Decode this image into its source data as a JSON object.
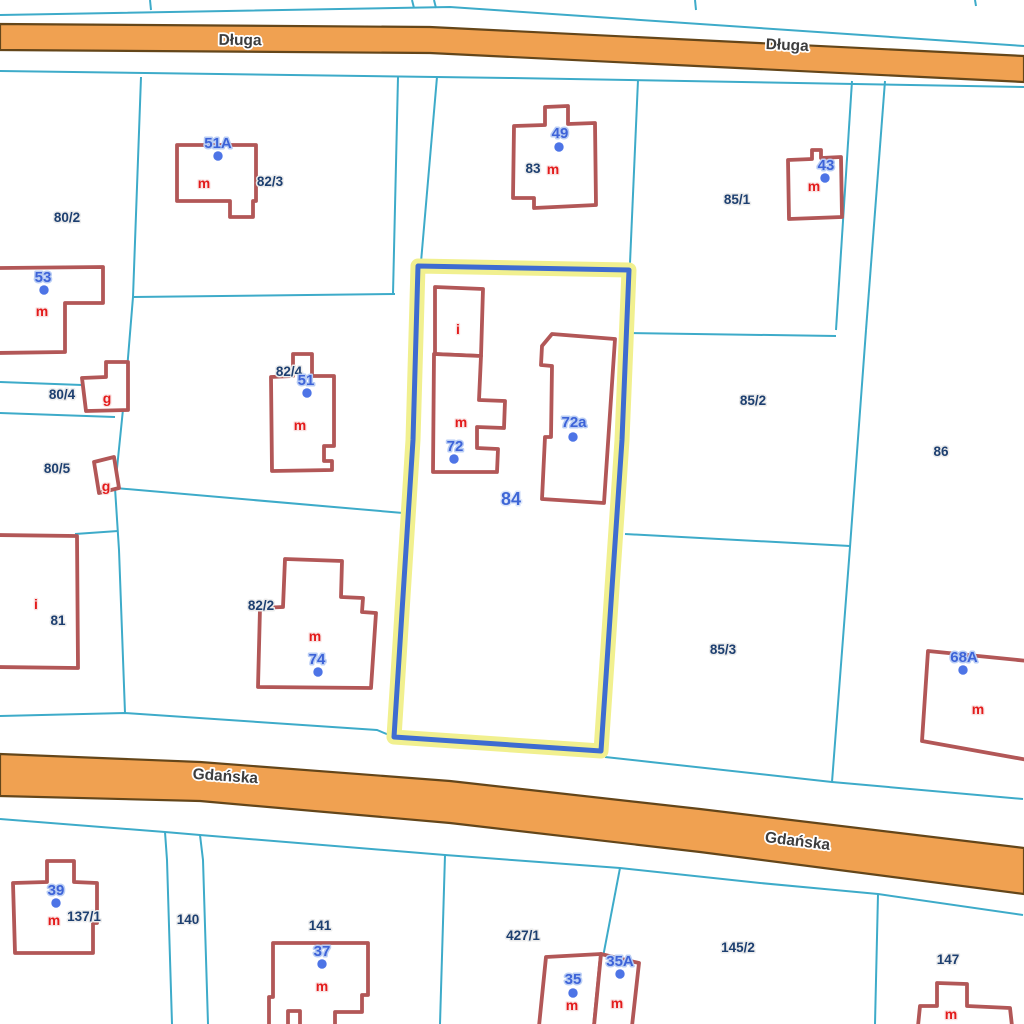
{
  "map": {
    "title": "Cadastral map with highlighted parcel 84 between Długa and Gdańska streets",
    "colors": {
      "background": "#ffffff",
      "boundary_line": "#3dabc9",
      "building_stroke": "#b25757",
      "building_fill": "#ffffff",
      "road_fill": "#f0a151",
      "road_edge": "#64461a",
      "road_text": "#3d3d3d",
      "road_text_halo": "#ffffff",
      "selected_stroke": "#3e6cd1",
      "selected_halo": "#f1f08f",
      "parcel_label": "#1d3f70",
      "parcel_label_halo": "#ececec",
      "selected_parcel_label": "#3e66d6",
      "selected_parcel_label_halo": "#dce6fa",
      "address_text": "#3d63d8",
      "address_halo": "#b9cdf4",
      "address_dot": "#4d74e6",
      "letter_text": "#e31b1b",
      "letter_halo": "#f9e3e3"
    },
    "roads": [
      {
        "name": "road-dluga",
        "path": "M0,24 L430,27 L1024,56 L1024,82 L430,53 L0,50 Z",
        "labels": [
          {
            "text": "Długa",
            "x": 240,
            "y": 45,
            "rotate": 0.8
          },
          {
            "text": "Długa",
            "x": 787,
            "y": 50,
            "rotate": 2.8
          }
        ]
      },
      {
        "name": "road-gdanska",
        "path": "M0,754 L200,762 L450,781 L700,809 L1024,848 L1024,894 L700,852 L450,823 L200,801 L0,796 Z",
        "labels": [
          {
            "text": "Gdańska",
            "x": 225,
            "y": 781,
            "rotate": 4
          },
          {
            "text": "Gdańska",
            "x": 797,
            "y": 846,
            "rotate": 7
          }
        ]
      }
    ],
    "boundaries": [
      {
        "points": "0,15 450,7 1024,46"
      },
      {
        "points": "150,0 151,10"
      },
      {
        "points": "412,0 414,8"
      },
      {
        "points": "434,0 436,8"
      },
      {
        "points": "695,0 696,10"
      },
      {
        "points": "975,0 976,6"
      },
      {
        "points": "0,71 512,78 1024,87"
      },
      {
        "points": "141,77 133,297 127,370 115,488 119,550 125,713"
      },
      {
        "points": "133,297 395,294"
      },
      {
        "points": "398,77 393,294"
      },
      {
        "points": "437,77 421,262"
      },
      {
        "points": "638,80 630,263"
      },
      {
        "points": "852,81 836,330"
      },
      {
        "points": "885,81 866,330"
      },
      {
        "points": "628,333 836,336"
      },
      {
        "points": "866,330 850,547 832,782"
      },
      {
        "points": "625,534 850,546"
      },
      {
        "points": "115,488 403,513"
      },
      {
        "points": "0,382 82,385"
      },
      {
        "points": "0,413 115,417"
      },
      {
        "points": "75,534 118,531"
      },
      {
        "points": "0,716 125,713 377,730 394,737"
      },
      {
        "points": "605,757 832,782 1023,799"
      },
      {
        "points": "0,819 165,832 200,835 445,855 512,860 620,868 760,883 878,894 1023,915"
      },
      {
        "points": "165,832 167,860 172,1024"
      },
      {
        "points": "200,835 203,860 208,1024"
      },
      {
        "points": "445,855 440,1024"
      },
      {
        "points": "620,868 603,957"
      },
      {
        "points": "878,894 875,1024"
      }
    ],
    "selected_parcel": {
      "path": "M418,266 L629,270 L622,440 L601,751 L394,737 L413,440 Z",
      "label": {
        "text": "84",
        "x": 511,
        "y": 505
      }
    },
    "parcel_labels": [
      {
        "text": "80/2",
        "x": 67,
        "y": 222
      },
      {
        "text": "82/3",
        "x": 270,
        "y": 186
      },
      {
        "text": "83",
        "x": 533,
        "y": 173
      },
      {
        "text": "85/1",
        "x": 737,
        "y": 204
      },
      {
        "text": "80/4",
        "x": 62,
        "y": 399
      },
      {
        "text": "82/4",
        "x": 289,
        "y": 376
      },
      {
        "text": "85/2",
        "x": 753,
        "y": 405
      },
      {
        "text": "86",
        "x": 941,
        "y": 456
      },
      {
        "text": "80/5",
        "x": 57,
        "y": 473
      },
      {
        "text": "81",
        "x": 58,
        "y": 625
      },
      {
        "text": "82/2",
        "x": 261,
        "y": 610
      },
      {
        "text": "85/3",
        "x": 723,
        "y": 654
      },
      {
        "text": "137/1",
        "x": 84,
        "y": 921
      },
      {
        "text": "140",
        "x": 188,
        "y": 924
      },
      {
        "text": "141",
        "x": 320,
        "y": 930
      },
      {
        "text": "427/1",
        "x": 523,
        "y": 940
      },
      {
        "text": "145/2",
        "x": 738,
        "y": 952
      },
      {
        "text": "147",
        "x": 948,
        "y": 964
      }
    ],
    "buildings": [
      {
        "name": "building-51a",
        "path": "M177,145 L256,145 L256,201 L253,201 L253,217 L230,217 L230,201 L177,201 Z",
        "letter": {
          "text": "m",
          "x": 204,
          "y": 188
        }
      },
      {
        "name": "building-49",
        "path": "M514,126 L545,125 L545,107 L568,106 L568,124 L595,123 L596,205 L534,208 L534,198 L513,198 Z",
        "letter": {
          "text": "m",
          "x": 553,
          "y": 174
        }
      },
      {
        "name": "building-43",
        "path": "M788,160 L812,159 L812,150 L821,150 L821,158 L841,157 L842,217 L789,219 Z",
        "letter": {
          "text": "m",
          "x": 814,
          "y": 191
        }
      },
      {
        "name": "building-53",
        "path": "M-4,268 L103,267 L103,303 L65,303 L65,352 L-4,353 Z",
        "letter": {
          "text": "m",
          "x": 42,
          "y": 316
        }
      },
      {
        "name": "building-garage-80-4",
        "path": "M82,378 L106,377 L106,362 L128,362 L128,410 L86,411 Z",
        "letter": {
          "text": "g",
          "x": 107,
          "y": 403
        }
      },
      {
        "name": "building-garage-80-5",
        "path": "M94,462 L114,457 L119,488 L99,493 Z",
        "letter": {
          "text": "g",
          "x": 106,
          "y": 491
        }
      },
      {
        "name": "building-51",
        "path": "M271,377 L293,376 L293,354 L312,354 L312,376 L334,376 L334,446 L324,446 L324,461 L332,461 L332,470 L272,471 Z",
        "letter": {
          "text": "m",
          "x": 300,
          "y": 430
        }
      },
      {
        "name": "building-84-i",
        "path": "M435,287 L483,289 L481,356 L435,354 Z",
        "letter": {
          "text": "i",
          "x": 458,
          "y": 334
        }
      },
      {
        "name": "building-84-m",
        "path": "M434,354 L481,356 L479,400 L505,401 L504,428 L477,427 L477,448 L498,449 L497,472 L433,472 Z",
        "letter": {
          "text": "m",
          "x": 461,
          "y": 427
        }
      },
      {
        "name": "building-72a",
        "path": "M552,334 L615,339 L604,503 L542,499 L545,437 L551,437 L552,366 L541,365 L542,346 Z"
      },
      {
        "name": "building-74",
        "path": "M285,559 L342,561 L341,597 L363,598 L362,612 L376,613 L371,688 L258,687 L260,608 L283,607 Z",
        "letter": {
          "text": "m",
          "x": 315,
          "y": 641
        }
      },
      {
        "name": "building-81",
        "path": "M-4,535 L77,536 L78,668 L-4,667 Z",
        "letter": {
          "text": "i",
          "x": 36,
          "y": 609
        }
      },
      {
        "name": "building-68a",
        "path": "M928,651 L1028,661 L1028,760 L922,741 Z",
        "letter": {
          "text": "m",
          "x": 978,
          "y": 714
        }
      },
      {
        "name": "building-39",
        "path": "M13,883 L47,882 L47,861 L74,861 L74,882 L97,883 L97,923 L93,923 L93,953 L15,953 Z",
        "letter": {
          "text": "m",
          "x": 54,
          "y": 925
        }
      },
      {
        "name": "building-37",
        "path": "M273,943 L368,943 L368,995 L362,995 L362,1012 L335,1012 L335,1026 L300,1026 L300,1011 L288,1011 L288,1026 L269,1026 L269,997 L273,997 Z",
        "letter": {
          "text": "m",
          "x": 322,
          "y": 991
        }
      },
      {
        "name": "building-35",
        "path": "M546,957 L601,954 L594,1026 L539,1026 Z",
        "letter": {
          "text": "m",
          "x": 572,
          "y": 1010
        }
      },
      {
        "name": "building-35a",
        "path": "M601,954 L639,963 L632,1026 L594,1026 Z",
        "letter": {
          "text": "m",
          "x": 617,
          "y": 1008
        }
      },
      {
        "name": "building-147",
        "path": "M937,983 L967,984 L967,1006 L1010,1008 L1012,1026 L918,1026 L920,1006 L937,1006 Z",
        "letter": {
          "text": "m",
          "x": 951,
          "y": 1019
        }
      }
    ],
    "addresses": [
      {
        "text": "51A",
        "x": 218,
        "y": 148,
        "dot": {
          "x": 218,
          "y": 156
        }
      },
      {
        "text": "49",
        "x": 560,
        "y": 138,
        "dot": {
          "x": 559,
          "y": 147
        }
      },
      {
        "text": "43",
        "x": 826,
        "y": 170,
        "dot": {
          "x": 825,
          "y": 178
        }
      },
      {
        "text": "53",
        "x": 43,
        "y": 282,
        "dot": {
          "x": 44,
          "y": 290
        }
      },
      {
        "text": "51",
        "x": 306,
        "y": 385,
        "dot": {
          "x": 307,
          "y": 393
        }
      },
      {
        "text": "72",
        "x": 455,
        "y": 451,
        "dot": {
          "x": 454,
          "y": 459
        }
      },
      {
        "text": "72a",
        "x": 574,
        "y": 427,
        "dot": {
          "x": 573,
          "y": 437
        }
      },
      {
        "text": "74",
        "x": 317,
        "y": 664,
        "dot": {
          "x": 318,
          "y": 672
        }
      },
      {
        "text": "68A",
        "x": 964,
        "y": 662,
        "dot": {
          "x": 963,
          "y": 670
        }
      },
      {
        "text": "39",
        "x": 56,
        "y": 895,
        "dot": {
          "x": 56,
          "y": 903
        }
      },
      {
        "text": "37",
        "x": 322,
        "y": 956,
        "dot": {
          "x": 322,
          "y": 964
        }
      },
      {
        "text": "35A",
        "x": 620,
        "y": 966,
        "dot": {
          "x": 620,
          "y": 974
        }
      },
      {
        "text": "35",
        "x": 573,
        "y": 984,
        "dot": {
          "x": 573,
          "y": 993
        }
      }
    ]
  }
}
